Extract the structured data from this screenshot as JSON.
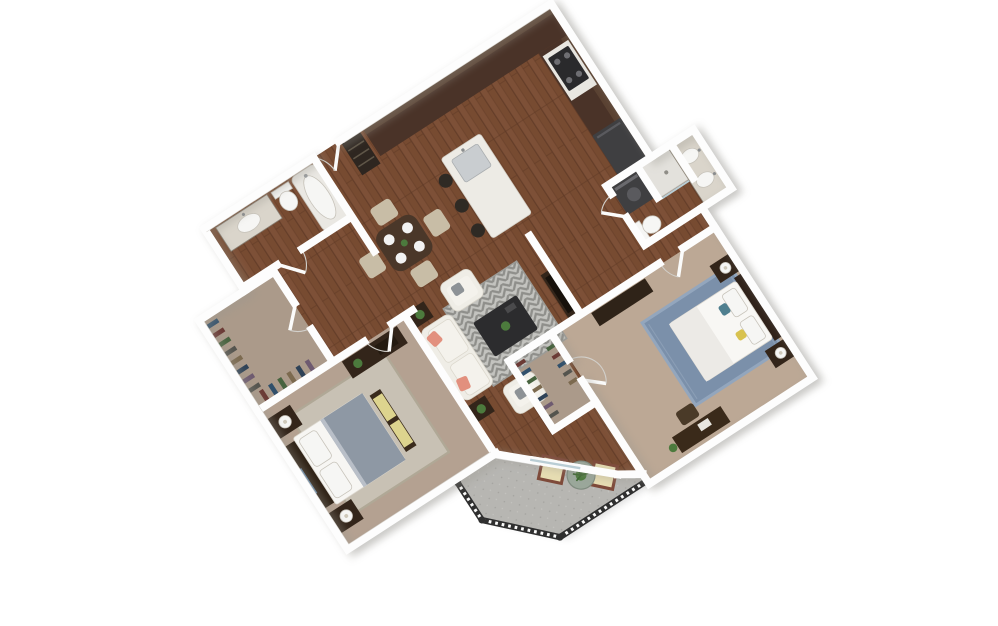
{
  "image": {
    "kind": "3d-rendered-floor-plan",
    "width_px": 998,
    "height_px": 626,
    "background": "#ffffff",
    "plan_rotation_deg": -33,
    "view": "isometric-top-down"
  },
  "unit": {
    "bedrooms": 2,
    "bathrooms": 2,
    "has_patio": true,
    "open_concept_kitchen_living": true
  },
  "palette": {
    "wall": "#fdfdfd",
    "shadow_gray": "#9a978f",
    "wood": "#7d5037",
    "wood_seam": "#5f3a26",
    "cabinet": "#4a3328",
    "counter": "#e9e7e1",
    "island": "#edebe5",
    "carpet_bedroom1": "#b4a191",
    "carpet_bedroom2": "#bca895",
    "carpet_closet": "#ab9a8a",
    "patio": "#b7b6b2",
    "railing": "#2f2f2f",
    "rug_living_a": "#c3c3bf",
    "rug_living_b": "#8f8f8b",
    "rug_bedroom1": "#c8c1b4",
    "rug_bedroom2": "#7b90aa",
    "sofa": "#efede6",
    "pillow_coral": "#e2907e",
    "pillow_yellow": "#ddd48e",
    "duvet_gray": "#8e98a4",
    "wood_furniture": "#33251a",
    "table_dark": "#2c2c2e",
    "dining_table": "#4a3729",
    "chair_beige": "#c8bda6",
    "appliance_dark": "#3f3f41",
    "fixture_white": "#f6f6f4",
    "glass": "#b9cdd4",
    "plant": "#4c7a3d",
    "art_blue": "#6b8fb3",
    "bed2_accent_teal": "#4f7f8f",
    "bed2_accent_yellow": "#d8c24f"
  },
  "rooms": [
    {
      "id": "kitchen",
      "floor": "hardwood",
      "features": [
        "l-shaped-walnut-counter",
        "cooktop",
        "refrigerator",
        "island-with-sink",
        "three-bar-stools"
      ]
    },
    {
      "id": "entry",
      "floor": "hardwood",
      "features": [
        "front-door",
        "pantry-closet"
      ]
    },
    {
      "id": "dining",
      "floor": "hardwood",
      "features": [
        "dark-wood-table",
        "four-beige-chairs",
        "four-place-settings",
        "centerpiece-plant"
      ]
    },
    {
      "id": "living",
      "floor": "hardwood",
      "features": [
        "cream-sofa",
        "two-armchairs",
        "dark-coffee-table",
        "gray-chevron-rug",
        "media-console",
        "two-side-tables",
        "potted-plants",
        "sliding-glass-door"
      ]
    },
    {
      "id": "bedroom-1",
      "floor": "carpet",
      "features": [
        "bed-gray-duvet",
        "dark-headboard",
        "two-nightstands-with-lamps",
        "bench-yellow-cushions",
        "dresser-with-plant",
        "area-rug",
        "blue-wall-art"
      ]
    },
    {
      "id": "bathroom-1",
      "floor": "hardwood",
      "features": [
        "vanity-sink",
        "toilet",
        "soaking-tub"
      ]
    },
    {
      "id": "walk-in-closet-1",
      "floor": "carpet",
      "features": [
        "hanging-clothes"
      ]
    },
    {
      "id": "bedroom-2",
      "floor": "carpet",
      "features": [
        "bed-white-duvet",
        "blue-area-rug",
        "two-nightstands-with-lamps",
        "long-dresser",
        "desk-with-chair"
      ]
    },
    {
      "id": "bathroom-2",
      "floor": "hardwood",
      "features": [
        "double-sink-vanity",
        "toilet",
        "shower",
        "washer-dryer"
      ]
    },
    {
      "id": "walk-in-closet-2",
      "floor": "carpet",
      "features": [
        "hanging-clothes-both-sides"
      ]
    },
    {
      "id": "patio",
      "floor": "concrete",
      "features": [
        "black-metal-railing",
        "two-lounge-chairs",
        "round-glass-table",
        "potted-plant"
      ]
    }
  ],
  "closet_clothes_colors": [
    "#31506b",
    "#6b3a35",
    "#47633f",
    "#54544e",
    "#7c6a4f",
    "#2e4257",
    "#6e5a70"
  ]
}
